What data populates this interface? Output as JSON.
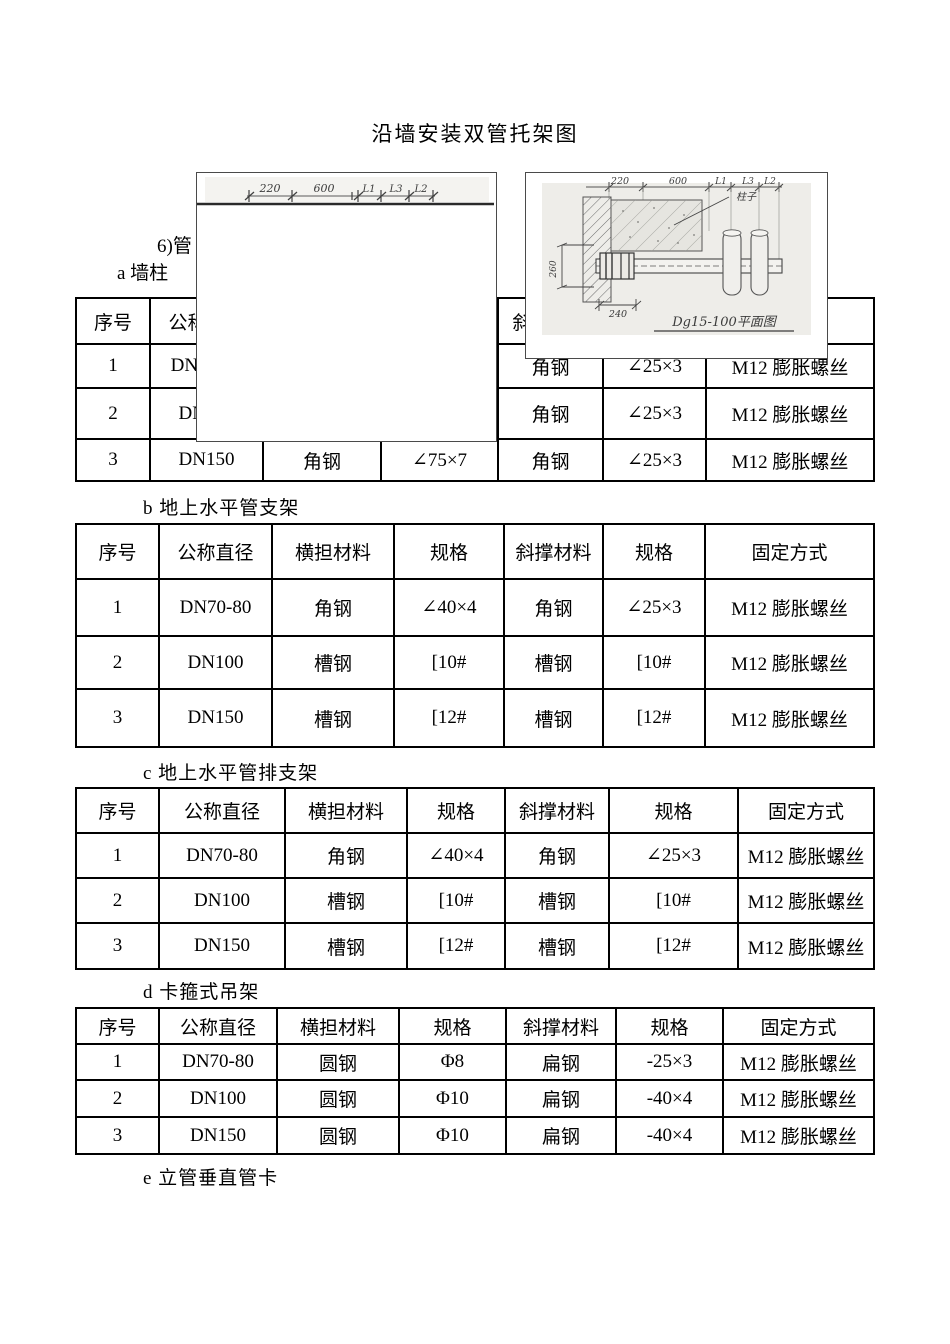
{
  "page": {
    "title": "沿墙安装双管托架图",
    "para_fragment": "6)管",
    "section_a": "a 墙柱",
    "section_b": "b 地上水平管支架",
    "section_c": "c 地上水平管排支架",
    "section_d": "d 卡箍式吊架",
    "section_e": "e 立管垂直管卡"
  },
  "table_a": {
    "headers": [
      "序号",
      "公称直径",
      "",
      "",
      "斜撑材料",
      "",
      "固定方式"
    ],
    "rows": [
      [
        "1",
        "DN70-80",
        "",
        "",
        "角钢",
        "∠25×3",
        "M12 膨胀螺丝"
      ],
      [
        "2",
        "DN100",
        "",
        "",
        "角钢",
        "∠25×3",
        "M12 膨胀螺丝"
      ],
      [
        "3",
        "DN150",
        "角钢",
        "∠75×7",
        "角钢",
        "∠25×3",
        "M12 膨胀螺丝"
      ]
    ]
  },
  "table_b": {
    "headers": [
      "序号",
      "公称直径",
      "横担材料",
      "规格",
      "斜撑材料",
      "规格",
      "固定方式"
    ],
    "rows": [
      [
        "1",
        "DN70-80",
        "角钢",
        "∠40×4",
        "角钢",
        "∠25×3",
        "M12 膨胀螺丝"
      ],
      [
        "2",
        "DN100",
        "槽钢",
        "[10#",
        "槽钢",
        "[10#",
        "M12 膨胀螺丝"
      ],
      [
        "3",
        "DN150",
        "槽钢",
        "[12#",
        "槽钢",
        "[12#",
        "M12 膨胀螺丝"
      ]
    ]
  },
  "table_c": {
    "headers": [
      "序号",
      "公称直径",
      "横担材料",
      "规格",
      "斜撑材料",
      "规格",
      "固定方式"
    ],
    "rows": [
      [
        "1",
        "DN70-80",
        "角钢",
        "∠40×4",
        "角钢",
        "∠25×3",
        "M12 膨胀螺丝"
      ],
      [
        "2",
        "DN100",
        "槽钢",
        "[10#",
        "槽钢",
        "[10#",
        "M12 膨胀螺丝"
      ],
      [
        "3",
        "DN150",
        "槽钢",
        "[12#",
        "槽钢",
        "[12#",
        "M12 膨胀螺丝"
      ]
    ]
  },
  "table_d": {
    "headers": [
      "序号",
      "公称直径",
      "横担材料",
      "规格",
      "斜撑材料",
      "规格",
      "固定方式"
    ],
    "rows": [
      [
        "1",
        "DN70-80",
        "圆钢",
        "Φ8",
        "扁钢",
        "-25×3",
        "M12 膨胀螺丝"
      ],
      [
        "2",
        "DN100",
        "圆钢",
        "Φ10",
        "扁钢",
        "-40×4",
        "M12 膨胀螺丝"
      ],
      [
        "3",
        "DN150",
        "圆钢",
        "Φ10",
        "扁钢",
        "-40×4",
        "M12 膨胀螺丝"
      ]
    ]
  },
  "left_figure": {
    "dim_labels": [
      "220",
      "600",
      "L1",
      "L3",
      "L2"
    ]
  },
  "right_figure": {
    "dim_labels": [
      "220",
      "600",
      "L1",
      "L3",
      "L2"
    ],
    "column_label": "柱子",
    "dim_left": "260",
    "dim_bottom": "240",
    "caption": "Dg15-100平面图"
  }
}
